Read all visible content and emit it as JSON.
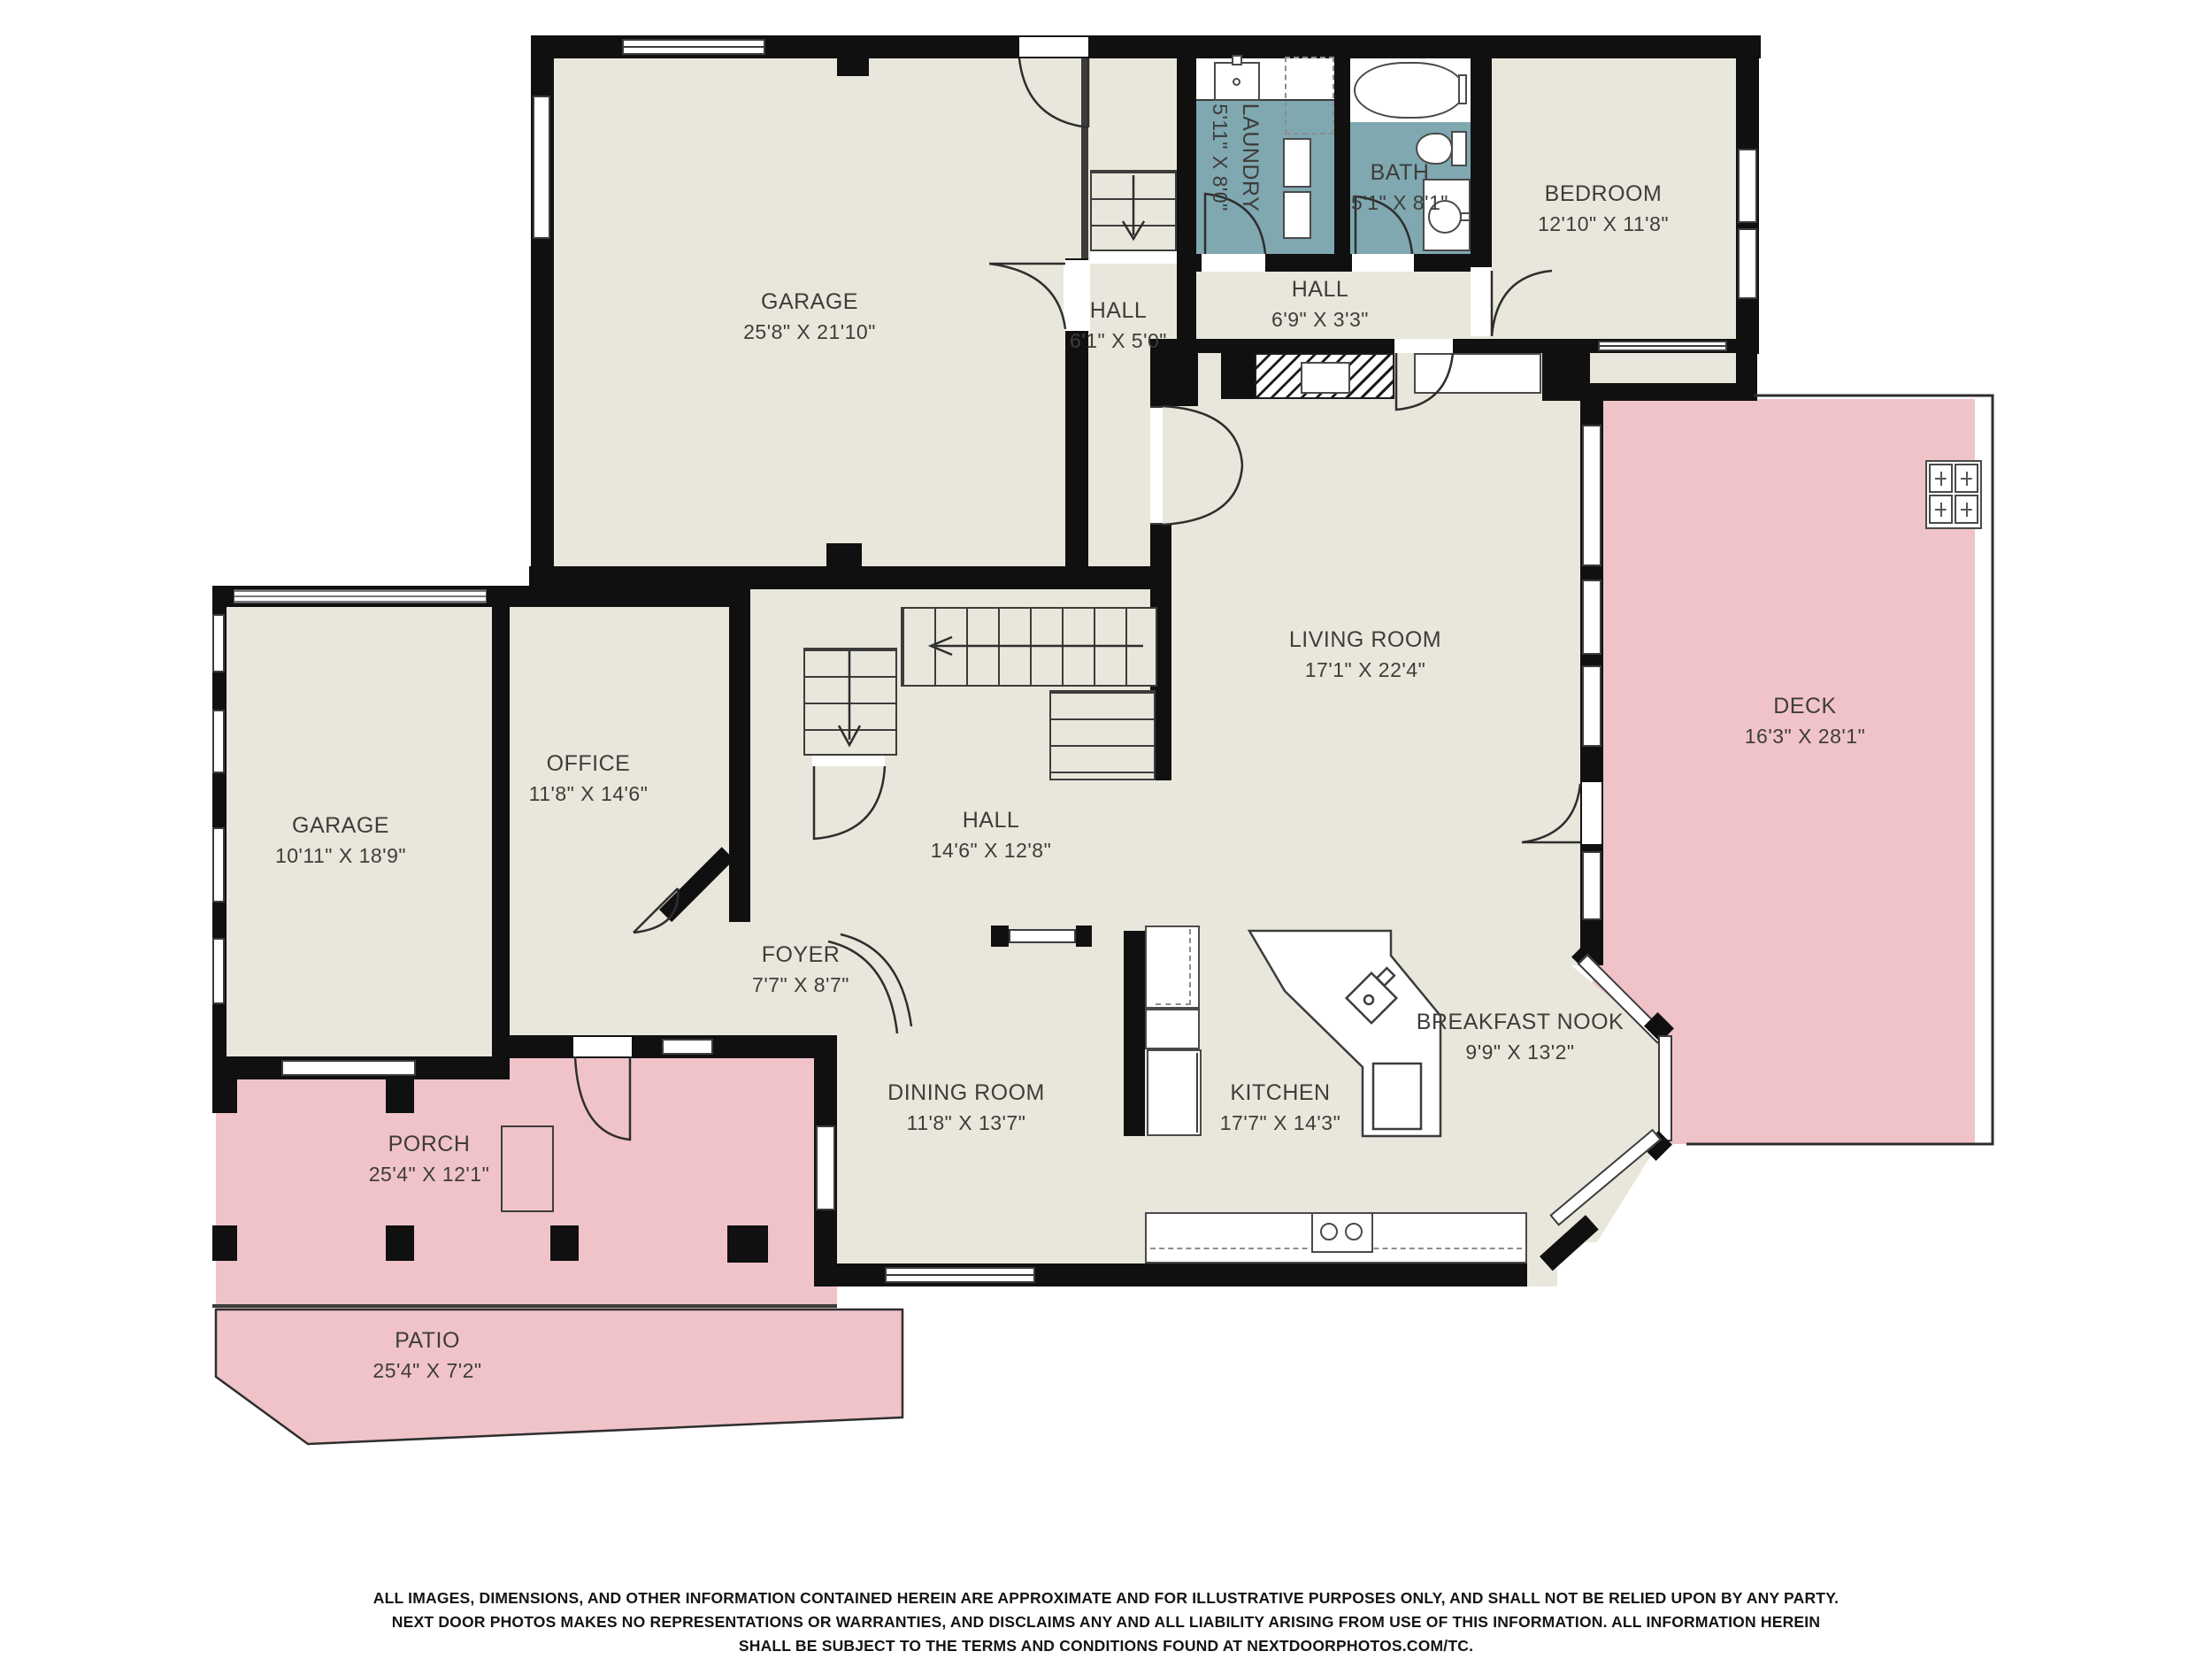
{
  "colors": {
    "floor": "#E9E7DB",
    "wet_room": "#7FA8B1",
    "outdoor": "#F0C3C9",
    "wall": "#101010",
    "text": "#3E3D39"
  },
  "rooms": {
    "garage_main": {
      "name": "GARAGE",
      "dims": "25'8\" X 21'10\""
    },
    "laundry": {
      "name": "LAUNDRY",
      "dims": "5'11\" X 8'0\""
    },
    "bath": {
      "name": "BATH",
      "dims": "5'1\" X 8'1\""
    },
    "bedroom": {
      "name": "BEDROOM",
      "dims": "12'10\" X 11'8\""
    },
    "hall_garage": {
      "name": "HALL",
      "dims": "6'1\" X 5'0\""
    },
    "hall_bath": {
      "name": "HALL",
      "dims": "6'9\" X 3'3\""
    },
    "living": {
      "name": "LIVING ROOM",
      "dims": "17'1\" X 22'4\""
    },
    "deck": {
      "name": "DECK",
      "dims": "16'3\" X 28'1\""
    },
    "garage_left": {
      "name": "GARAGE",
      "dims": "10'11\" X 18'9\""
    },
    "office": {
      "name": "OFFICE",
      "dims": "11'8\" X 14'6\""
    },
    "hall_main": {
      "name": "HALL",
      "dims": "14'6\" X 12'8\""
    },
    "foyer": {
      "name": "FOYER",
      "dims": "7'7\" X 8'7\""
    },
    "dining": {
      "name": "DINING ROOM",
      "dims": "11'8\" X 13'7\""
    },
    "kitchen": {
      "name": "KITCHEN",
      "dims": "17'7\" X 14'3\""
    },
    "nook": {
      "name": "BREAKFAST NOOK",
      "dims": "9'9\" X 13'2\""
    },
    "porch": {
      "name": "PORCH",
      "dims": "25'4\" X 12'1\""
    },
    "patio": {
      "name": "PATIO",
      "dims": "25'4\" X 7'2\""
    }
  },
  "footer": {
    "line1": "ALL IMAGES, DIMENSIONS, AND OTHER INFORMATION CONTAINED HEREIN ARE APPROXIMATE AND FOR ILLUSTRATIVE PURPOSES ONLY, AND SHALL NOT BE RELIED UPON BY ANY PARTY.",
    "line2": "NEXT DOOR PHOTOS MAKES NO REPRESENTATIONS OR WARRANTIES, AND DISCLAIMS ANY AND ALL LIABILITY ARISING FROM USE OF THIS INFORMATION. ALL INFORMATION HEREIN",
    "line3": "SHALL BE SUBJECT TO THE TERMS AND CONDITIONS FOUND AT NEXTDOORPHOTOS.COM/TC."
  }
}
